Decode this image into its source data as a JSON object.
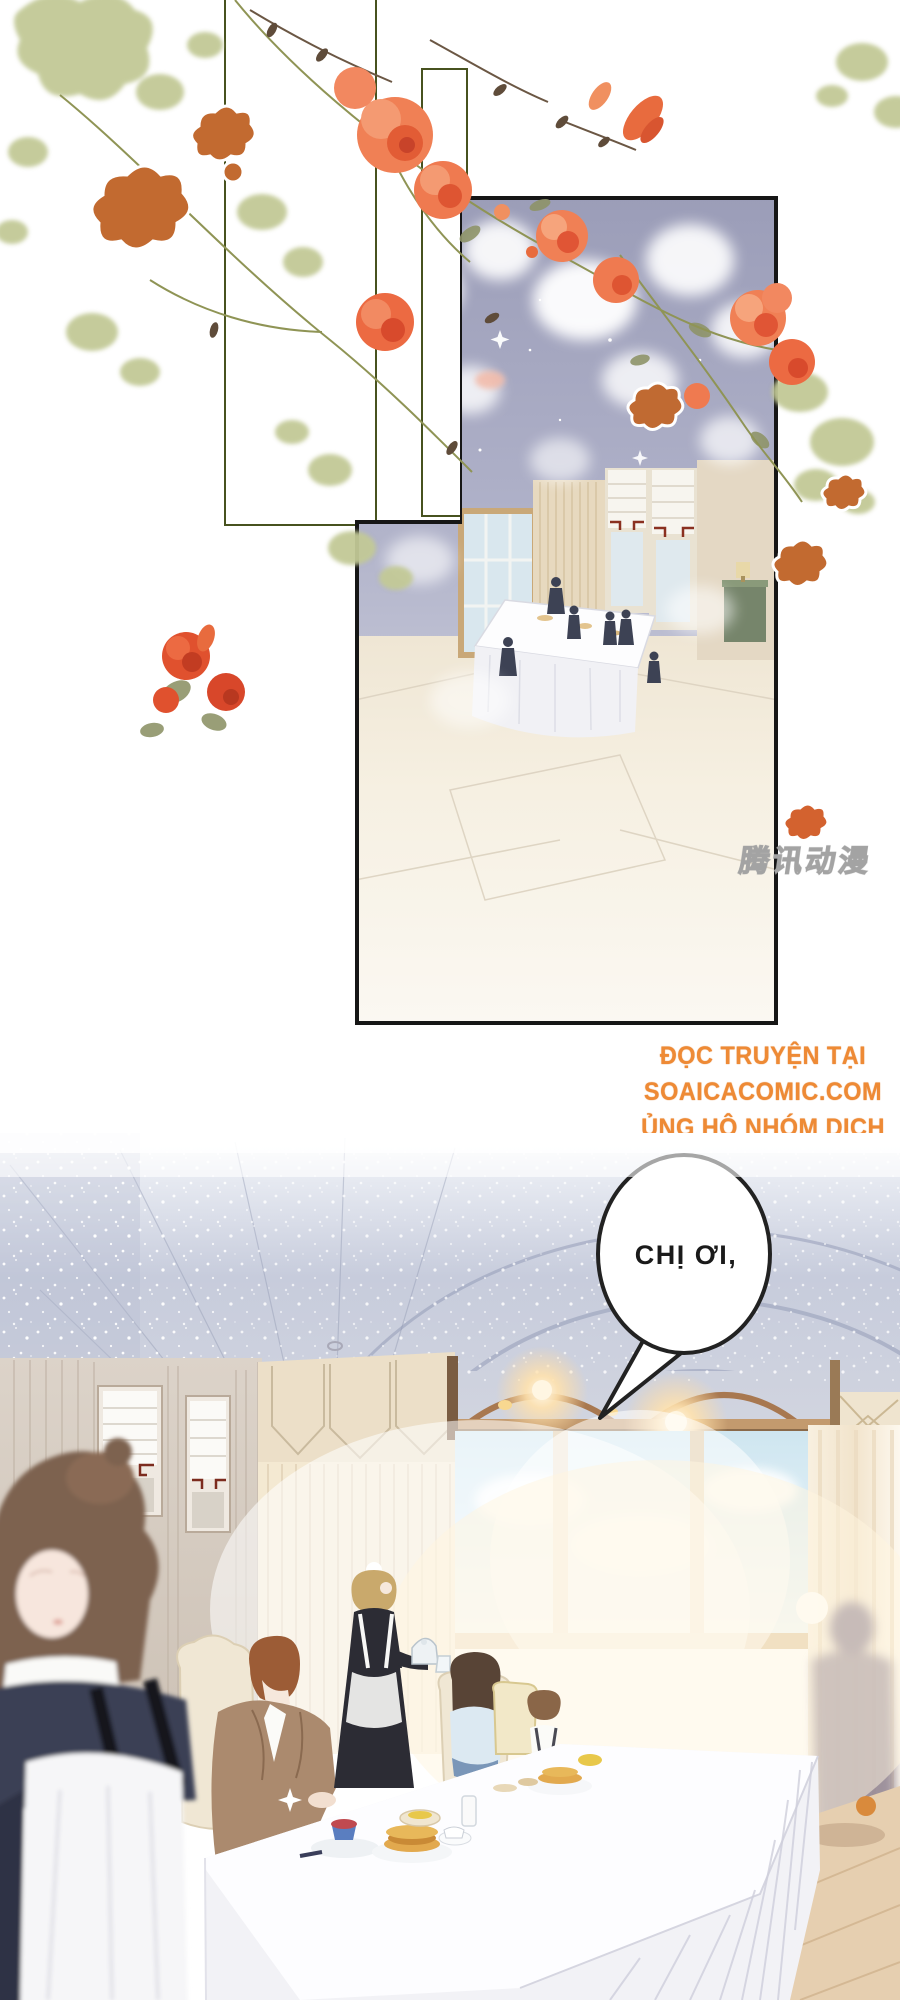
{
  "page": {
    "kind": "comic-page"
  },
  "top_panel": {
    "watermark_text": "腾讯动漫"
  },
  "credits": {
    "line1": "ĐỌC TRUYỆN TẠI",
    "line2": "SOAICACOMIC.COM",
    "line3": "ỦNG HỘ NHÓM DỊCH"
  },
  "bottom_panel": {
    "speech_bubble_text": "CHỊ ƠI,"
  },
  "colors": {
    "credit_orange": "#ee8a35",
    "flower_coral": "#f08055",
    "flower_deep_red": "#e0512e",
    "flower_rust": "#c26a30",
    "leaf_sage": "#c2c996",
    "frame_green": "#47521f",
    "panel_border": "#161616",
    "panel_lavender": "#a9abc4",
    "maid_dress_black": "#2c2c34",
    "suit_brown": "#ab8a6e",
    "shade_trim_maroon": "#7c2b1e",
    "wood_valance": "#a87850"
  }
}
